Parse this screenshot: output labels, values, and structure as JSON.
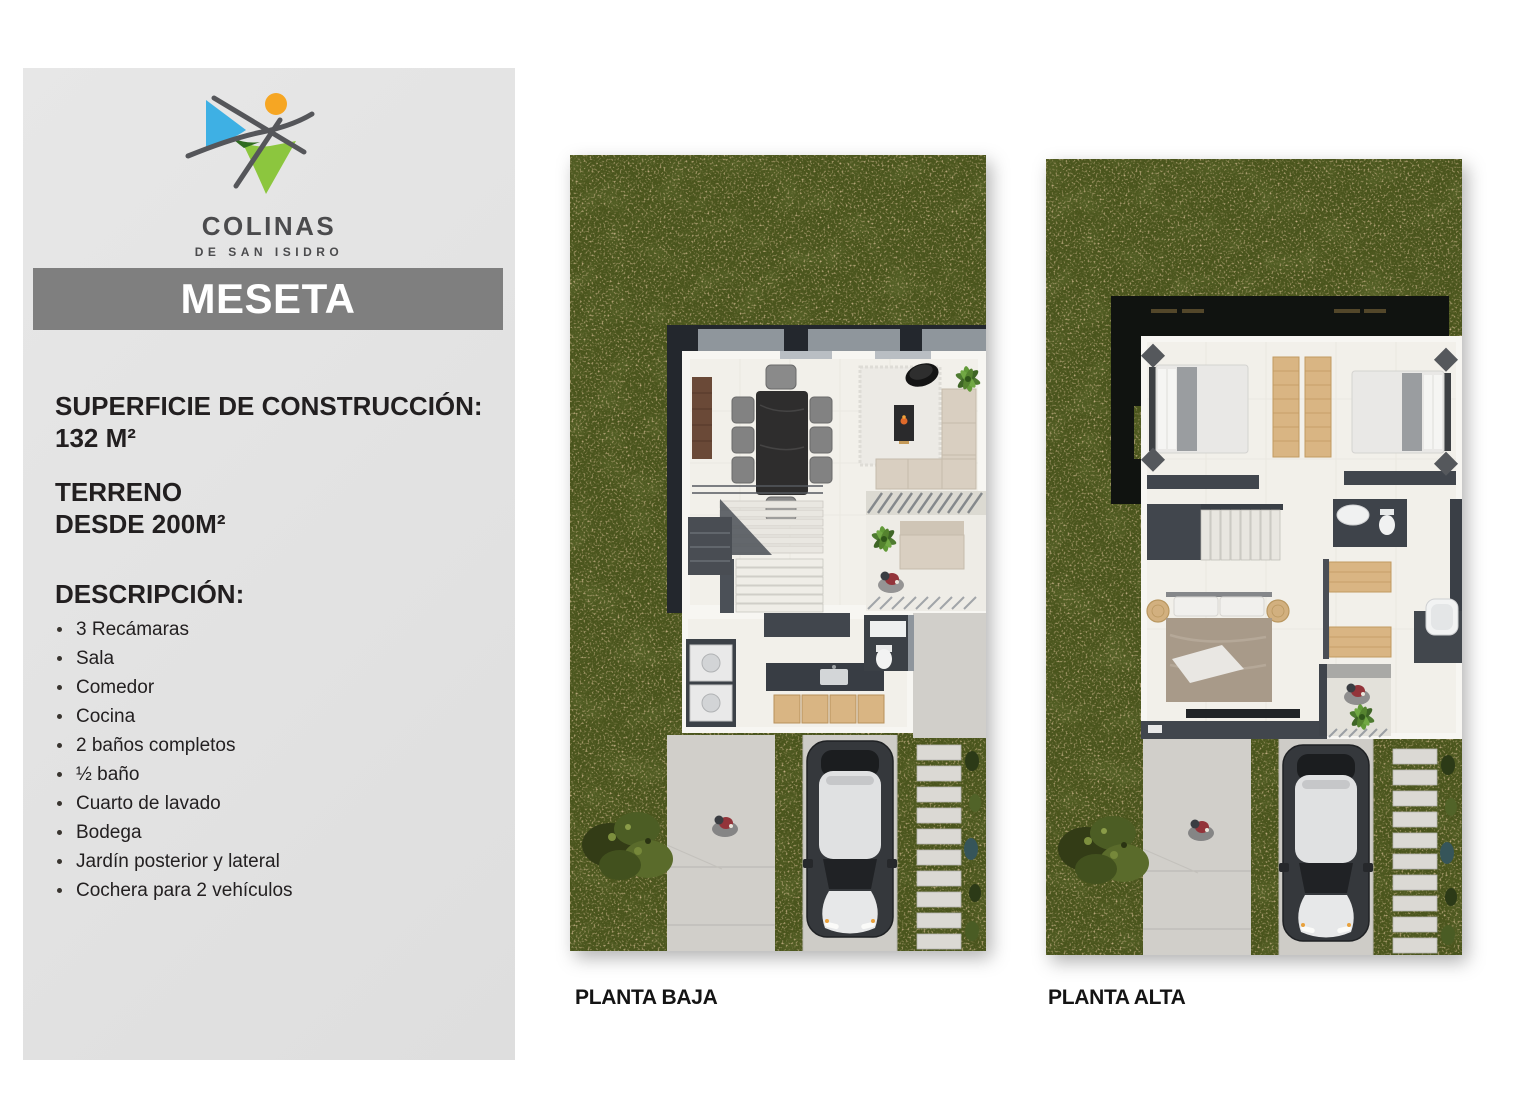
{
  "sidebar": {
    "logo": {
      "brand": "COLINAS",
      "subbrand": "DE SAN ISIDRO"
    },
    "title_bar": {
      "label": "MESETA"
    },
    "specs": {
      "construction_label": "SUPERFICIE DE CONSTRUCCIÓN:",
      "construction_value": "132 M²",
      "land_label": "TERRENO",
      "land_value": "DESDE 200M²"
    },
    "description": {
      "heading": "DESCRIPCIÓN:",
      "items": [
        "3 Recámaras",
        "Sala",
        "Comedor",
        "Cocina",
        "2 baños completos",
        "½ baño",
        "Cuarto de lavado",
        "Bodega",
        "Jardín posterior y lateral",
        "Cochera para 2 vehículos"
      ]
    }
  },
  "plans": {
    "baja": {
      "label": "PLANTA BAJA"
    },
    "alta": {
      "label": "PLANTA ALTA"
    }
  },
  "colors": {
    "sidebar_bg": "#e3e3e3",
    "title_bar_bg": "#7f7f7f",
    "title_text": "#ffffff",
    "text_dark": "#221f20",
    "brand_text": "#4b4b4d",
    "logo_blue": "#3eb0e4",
    "logo_green": "#8cc63e",
    "logo_orange": "#f6a623",
    "logo_line": "#55565a",
    "grass": "#4a551d",
    "grass_speckle": "#a67d4b",
    "concrete": "#d1cfca",
    "roof_dark": "#23272d",
    "wall_white": "#f7f6f2",
    "floor": "#f2f0ea",
    "interior_dark": "#41464d",
    "wood": "#d9b583",
    "wood_dark": "#6a4937",
    "sofa": "#d9cfc1",
    "car_body": "#35383c",
    "car_top": "#e0e1e2",
    "accent_orange": "#c9722d"
  }
}
